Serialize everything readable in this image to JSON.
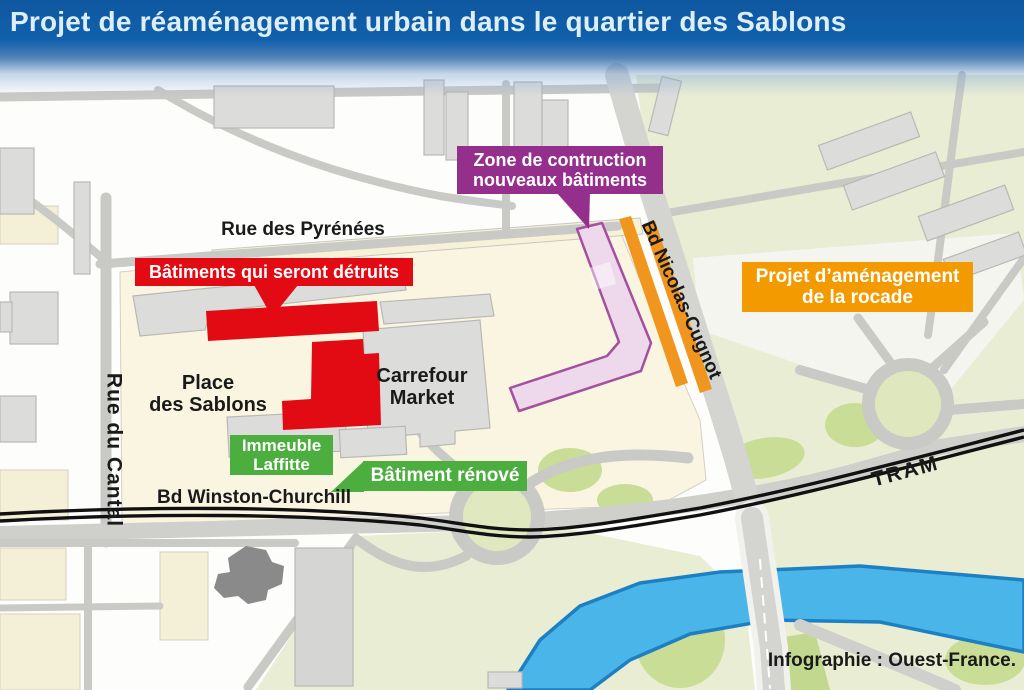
{
  "header": {
    "title": "Projet de réaménagement urbain dans le quartier des Sablons"
  },
  "badges": {
    "destroyed": {
      "label": "Bâtiments qui seront détruits",
      "color": "#e30b13"
    },
    "construction": {
      "line1": "Zone de contruction",
      "line2": "nouveaux bâtiments",
      "color": "#942f8c"
    },
    "rocade": {
      "line1": "Projet d’aménagement",
      "line2": "de la rocade",
      "color": "#f39a00"
    },
    "immeuble": {
      "line1": "Immeuble",
      "line2": "Laffitte",
      "color": "#4cae3f"
    },
    "renove": {
      "label": "Bâtiment rénové",
      "color": "#4cae3f"
    }
  },
  "map_labels": {
    "rue_des_pyrenees": "Rue des Pyrénées",
    "place_line1": "Place",
    "place_line2": "des Sablons",
    "carrefour_line1": "Carrefour",
    "carrefour_line2": "Market",
    "rue_du_cantal": "Rue du Cantal",
    "bd_winston": "Bd Winston-Churchill",
    "bd_nicolas": "Bd Nicolas-Cugnot",
    "tram": "TRAM"
  },
  "credit": "Infographie : Ouest-France.",
  "colors": {
    "header_blue": "#1160ac",
    "title_text": "#dceef8",
    "destroyed_red": "#e30b13",
    "construction_purple": "#942f8c",
    "construction_zone_fill": "#eed9ec",
    "construction_zone_border": "#a4509e",
    "rocade_orange": "#f39a00",
    "rocade_strip_orange": "#f0961e",
    "renovated_green": "#4cae3f",
    "river_blue": "#4ab5e8",
    "river_border": "#1d80c2",
    "greenspace": "#e9edd4",
    "green_patch": "#cadd97",
    "road_gray": "#c9c9c6",
    "building_gray": "#dcdcda",
    "dark_building_gray": "#8a8a8a",
    "tram_black": "#111111",
    "cream": "#f8f3dd"
  }
}
